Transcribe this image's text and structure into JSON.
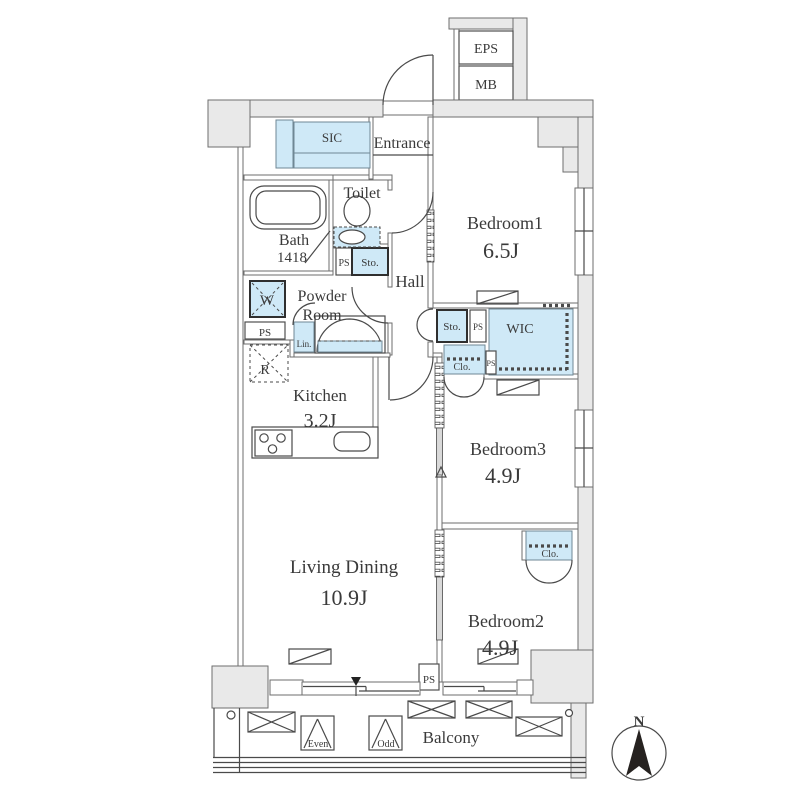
{
  "rooms": {
    "bedroom1": {
      "name": "Bedroom1",
      "size": "6.5J"
    },
    "bedroom2": {
      "name": "Bedroom2",
      "size": "4.9J"
    },
    "bedroom3": {
      "name": "Bedroom3",
      "size": "4.9J"
    },
    "living_dining": {
      "name": "Living Dining",
      "size": "10.9J"
    },
    "kitchen": {
      "name": "Kitchen",
      "size": "3.2J"
    },
    "bath": {
      "name": "Bath",
      "size": "1418"
    },
    "toilet": {
      "name": "Toilet"
    },
    "powder_room": {
      "line1": "Powder",
      "line2": "Room"
    },
    "hall": {
      "name": "Hall"
    },
    "entrance": {
      "name": "Entrance"
    },
    "balcony": {
      "name": "Balcony"
    }
  },
  "storage": {
    "sic": "SIC",
    "wic": "WIC",
    "sto": "Sto.",
    "clo": "Clo.",
    "lin": "Lin.",
    "washer": "W",
    "fridge": "R"
  },
  "utility": {
    "ps": "PS",
    "eps": "EPS",
    "mb": "MB"
  },
  "balcony_markers": {
    "even": "Even",
    "odd": "Odd"
  },
  "compass": {
    "north": "N"
  },
  "colors": {
    "fixture": "#cfe9f7",
    "wall": "#e9e9e9",
    "wall_stroke": "#6e6e6e",
    "line": "#4a4a4a",
    "text": "#3a3a3a",
    "needle": "#262220"
  }
}
